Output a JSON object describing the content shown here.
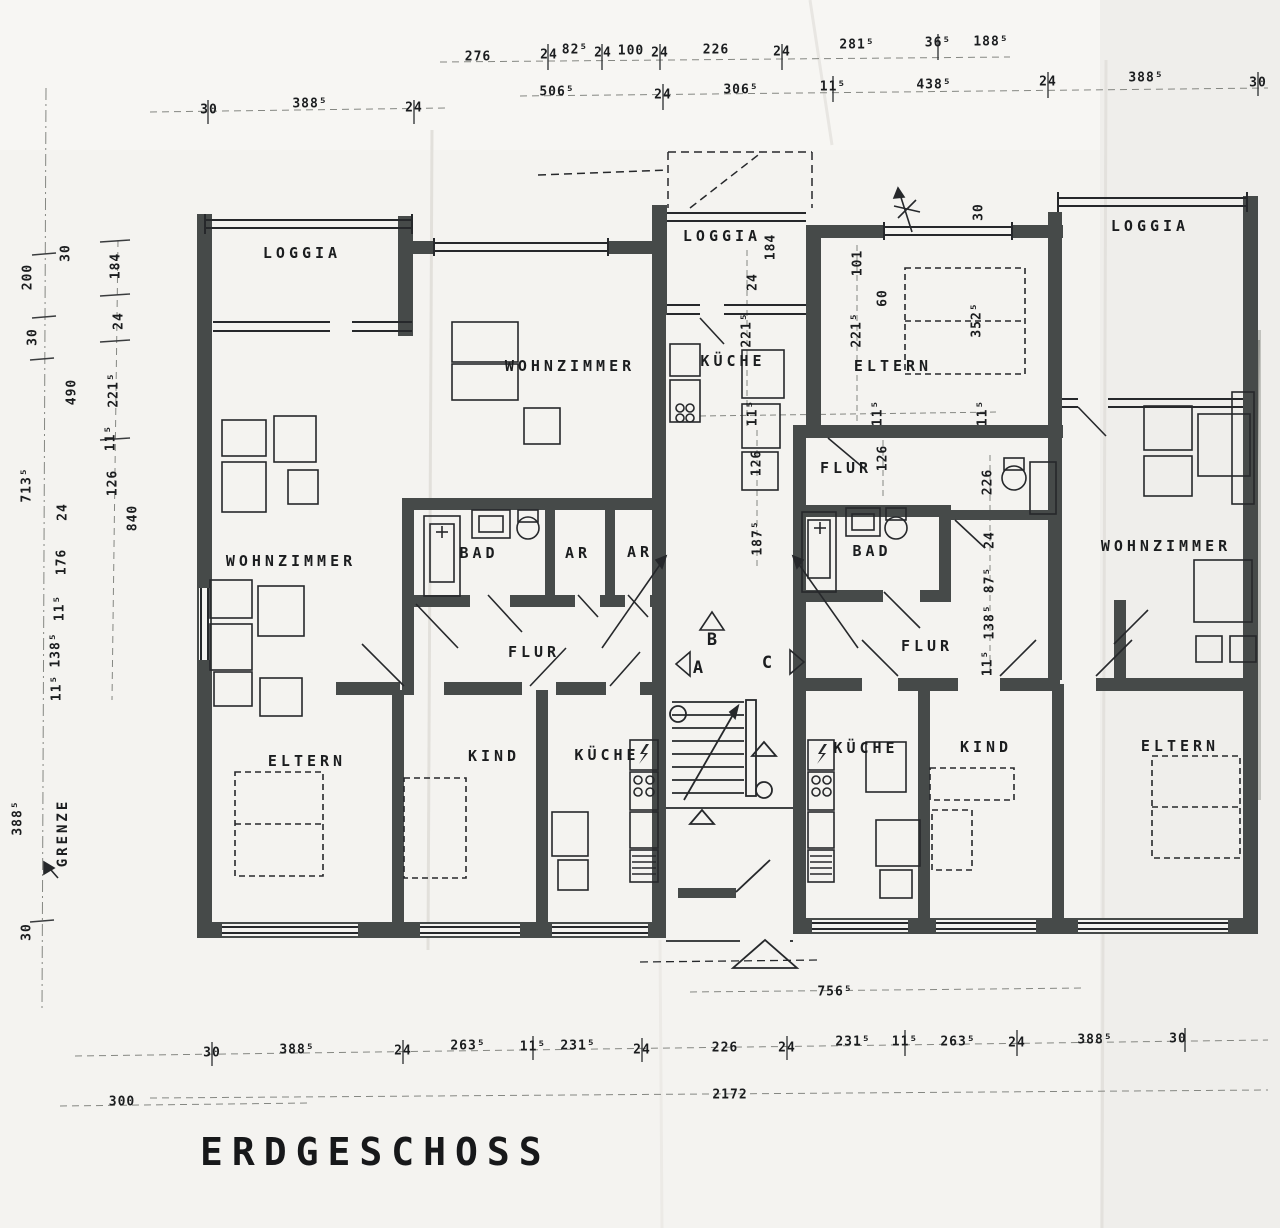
{
  "title": "ERDGESCHOSS",
  "plan": {
    "grenze": {
      "t": "GRENZE",
      "x": 63,
      "y": 833,
      "r": 1
    },
    "room_labels": [
      {
        "t": "LOGGIA",
        "x": 302,
        "y": 253
      },
      {
        "t": "WOHNZIMMER",
        "x": 570,
        "y": 366
      },
      {
        "t": "LOGGIA",
        "x": 722,
        "y": 236
      },
      {
        "t": "KÜCHE",
        "x": 733,
        "y": 361
      },
      {
        "t": "ELTERN",
        "x": 893,
        "y": 366
      },
      {
        "t": "LOGGIA",
        "x": 1150,
        "y": 226
      },
      {
        "t": "WOHNZIMMER",
        "x": 291,
        "y": 561
      },
      {
        "t": "BAD",
        "x": 479,
        "y": 553
      },
      {
        "t": "AR",
        "x": 578,
        "y": 553
      },
      {
        "t": "AR",
        "x": 640,
        "y": 552
      },
      {
        "t": "FLUR",
        "x": 534,
        "y": 652
      },
      {
        "t": "FLUR",
        "x": 846,
        "y": 468
      },
      {
        "t": "BAD",
        "x": 872,
        "y": 551
      },
      {
        "t": "FLUR",
        "x": 927,
        "y": 646
      },
      {
        "t": "WOHNZIMMER",
        "x": 1166,
        "y": 546
      },
      {
        "t": "ELTERN",
        "x": 307,
        "y": 761
      },
      {
        "t": "KIND",
        "x": 494,
        "y": 756
      },
      {
        "t": "KÜCHE",
        "x": 607,
        "y": 755
      },
      {
        "t": "KÜCHE",
        "x": 866,
        "y": 748
      },
      {
        "t": "KIND",
        "x": 986,
        "y": 747
      },
      {
        "t": "ELTERN",
        "x": 1180,
        "y": 746
      }
    ],
    "section_markers": [
      {
        "t": "A",
        "x": 698,
        "y": 668
      },
      {
        "t": "B",
        "x": 712,
        "y": 640
      },
      {
        "t": "C",
        "x": 767,
        "y": 663
      }
    ],
    "dimensions": [
      {
        "t": "276",
        "x": 478,
        "y": 57
      },
      {
        "t": "24",
        "x": 549,
        "y": 55
      },
      {
        "t": "82⁵",
        "x": 575,
        "y": 50
      },
      {
        "t": "24",
        "x": 603,
        "y": 53
      },
      {
        "t": "100",
        "x": 631,
        "y": 51
      },
      {
        "t": "24",
        "x": 660,
        "y": 53
      },
      {
        "t": "226",
        "x": 716,
        "y": 50
      },
      {
        "t": "24",
        "x": 782,
        "y": 52
      },
      {
        "t": "281⁵",
        "x": 857,
        "y": 45
      },
      {
        "t": "36⁵",
        "x": 938,
        "y": 43
      },
      {
        "t": "188⁵",
        "x": 991,
        "y": 42
      },
      {
        "t": "506⁵",
        "x": 557,
        "y": 92
      },
      {
        "t": "24",
        "x": 663,
        "y": 95
      },
      {
        "t": "306⁵",
        "x": 741,
        "y": 90
      },
      {
        "t": "11⁵",
        "x": 833,
        "y": 87
      },
      {
        "t": "438⁵",
        "x": 934,
        "y": 85
      },
      {
        "t": "24",
        "x": 1048,
        "y": 82
      },
      {
        "t": "388⁵",
        "x": 1146,
        "y": 78
      },
      {
        "t": "30",
        "x": 1258,
        "y": 83
      },
      {
        "t": "30",
        "x": 209,
        "y": 110
      },
      {
        "t": "388⁵",
        "x": 310,
        "y": 104
      },
      {
        "t": "24",
        "x": 414,
        "y": 108
      },
      {
        "t": "200",
        "x": 28,
        "y": 277,
        "r": 1
      },
      {
        "t": "30",
        "x": 33,
        "y": 337,
        "r": 1
      },
      {
        "t": "30",
        "x": 66,
        "y": 253,
        "r": 1
      },
      {
        "t": "184",
        "x": 116,
        "y": 266,
        "r": 1
      },
      {
        "t": "24",
        "x": 119,
        "y": 321,
        "r": 1
      },
      {
        "t": "490",
        "x": 72,
        "y": 392,
        "r": 1
      },
      {
        "t": "221⁵",
        "x": 114,
        "y": 390,
        "r": 1
      },
      {
        "t": "11⁵",
        "x": 111,
        "y": 438,
        "r": 1
      },
      {
        "t": "713⁵",
        "x": 27,
        "y": 485,
        "r": 1
      },
      {
        "t": "126",
        "x": 113,
        "y": 483,
        "r": 1
      },
      {
        "t": "24",
        "x": 63,
        "y": 512,
        "r": 1
      },
      {
        "t": "840",
        "x": 133,
        "y": 518,
        "r": 1
      },
      {
        "t": "176",
        "x": 62,
        "y": 562,
        "r": 1
      },
      {
        "t": "11⁵",
        "x": 60,
        "y": 608,
        "r": 1
      },
      {
        "t": "138⁵",
        "x": 56,
        "y": 650,
        "r": 1
      },
      {
        "t": "11⁵",
        "x": 57,
        "y": 688,
        "r": 1
      },
      {
        "t": "388⁵",
        "x": 18,
        "y": 818,
        "r": 1
      },
      {
        "t": "30",
        "x": 27,
        "y": 932,
        "r": 1
      },
      {
        "t": "184",
        "x": 771,
        "y": 247,
        "r": 1
      },
      {
        "t": "24",
        "x": 753,
        "y": 282,
        "r": 1
      },
      {
        "t": "221⁵",
        "x": 747,
        "y": 330,
        "r": 1
      },
      {
        "t": "101",
        "x": 858,
        "y": 263,
        "r": 1
      },
      {
        "t": "60",
        "x": 883,
        "y": 298,
        "r": 1
      },
      {
        "t": "221⁵",
        "x": 857,
        "y": 330,
        "r": 1
      },
      {
        "t": "30",
        "x": 979,
        "y": 212,
        "r": 1
      },
      {
        "t": "352⁵",
        "x": 977,
        "y": 320,
        "r": 1
      },
      {
        "t": "11⁵",
        "x": 753,
        "y": 413,
        "r": 1
      },
      {
        "t": "11⁵",
        "x": 878,
        "y": 413,
        "r": 1
      },
      {
        "t": "11⁵",
        "x": 983,
        "y": 413,
        "r": 1
      },
      {
        "t": "126",
        "x": 757,
        "y": 463,
        "r": 1
      },
      {
        "t": "126",
        "x": 883,
        "y": 458,
        "r": 1
      },
      {
        "t": "187⁵",
        "x": 758,
        "y": 538,
        "r": 1
      },
      {
        "t": "226",
        "x": 988,
        "y": 482,
        "r": 1
      },
      {
        "t": "24",
        "x": 990,
        "y": 540,
        "r": 1
      },
      {
        "t": "87⁵",
        "x": 990,
        "y": 580,
        "r": 1
      },
      {
        "t": "138⁵",
        "x": 990,
        "y": 622,
        "r": 1
      },
      {
        "t": "11⁵",
        "x": 988,
        "y": 663,
        "r": 1
      },
      {
        "t": "756⁵",
        "x": 835,
        "y": 992
      },
      {
        "t": "30",
        "x": 212,
        "y": 1053
      },
      {
        "t": "388⁵",
        "x": 297,
        "y": 1050
      },
      {
        "t": "24",
        "x": 403,
        "y": 1051
      },
      {
        "t": "263⁵",
        "x": 468,
        "y": 1046
      },
      {
        "t": "11⁵",
        "x": 533,
        "y": 1047
      },
      {
        "t": "231⁵",
        "x": 578,
        "y": 1046
      },
      {
        "t": "24",
        "x": 642,
        "y": 1050
      },
      {
        "t": "226",
        "x": 725,
        "y": 1048
      },
      {
        "t": "24",
        "x": 787,
        "y": 1048
      },
      {
        "t": "231⁵",
        "x": 853,
        "y": 1042
      },
      {
        "t": "11⁵",
        "x": 905,
        "y": 1042
      },
      {
        "t": "263⁵",
        "x": 958,
        "y": 1042
      },
      {
        "t": "24",
        "x": 1017,
        "y": 1043
      },
      {
        "t": "388⁵",
        "x": 1095,
        "y": 1040
      },
      {
        "t": "30",
        "x": 1178,
        "y": 1039
      },
      {
        "t": "2172",
        "x": 730,
        "y": 1095
      },
      {
        "t": "300",
        "x": 122,
        "y": 1102
      }
    ],
    "colors": {
      "paper": "#f4f3f0",
      "wall": "#464a49",
      "ink": "#26282b",
      "guide": "#858782"
    }
  }
}
